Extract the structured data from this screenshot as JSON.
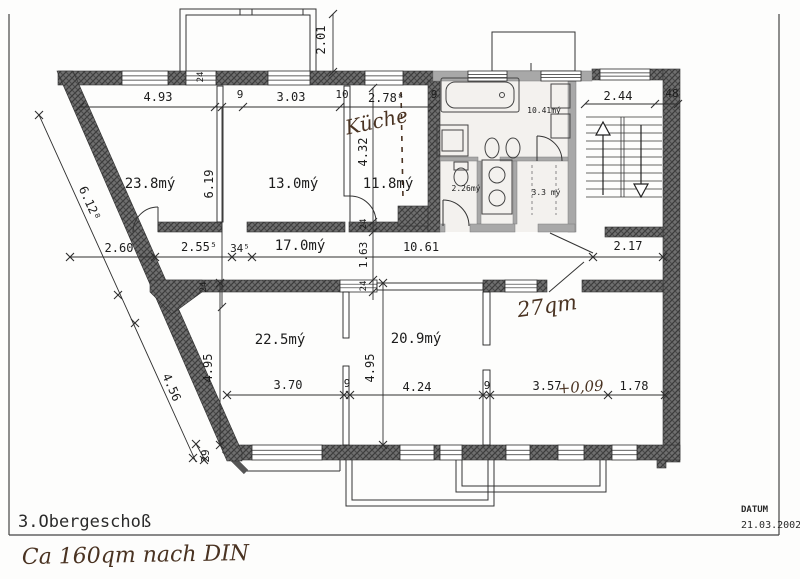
{
  "page": {
    "title": "3.Obergeschoß",
    "datum_label": "DATUM",
    "datum_value": "21.03.2002"
  },
  "plan": {
    "room_labels": [
      {
        "text": "23.8mý",
        "x": 150,
        "y": 188
      },
      {
        "text": "13.0mý",
        "x": 293,
        "y": 188
      },
      {
        "text": "11.8mý",
        "x": 388,
        "y": 188
      },
      {
        "text": "17.0mý",
        "x": 300,
        "y": 250
      },
      {
        "text": "22.5mý",
        "x": 280,
        "y": 344
      },
      {
        "text": "20.9mý",
        "x": 416,
        "y": 343
      },
      {
        "text": "10.41mý",
        "x": 544,
        "y": 113,
        "size": 8
      },
      {
        "text": "2.26mý",
        "x": 466,
        "y": 191,
        "size": 8
      },
      {
        "text": "3.3 mý",
        "x": 546,
        "y": 195,
        "size": 8
      }
    ],
    "dim_labels": [
      {
        "text": "4.93",
        "x": 158,
        "y": 101
      },
      {
        "text": "9",
        "x": 240,
        "y": 98,
        "size": 11
      },
      {
        "text": "3.03",
        "x": 291,
        "y": 101
      },
      {
        "text": "10",
        "x": 342,
        "y": 98,
        "size": 11
      },
      {
        "text": "2.78⁸",
        "x": 386,
        "y": 102
      },
      {
        "text": "9",
        "x": 434,
        "y": 98,
        "size": 11
      },
      {
        "text": "2.44",
        "x": 618,
        "y": 100
      },
      {
        "text": "48",
        "x": 672,
        "y": 97,
        "size": 11
      },
      {
        "text": "2.01",
        "x": 325,
        "y": 40,
        "rot": -90
      },
      {
        "text": "6.19",
        "x": 213,
        "y": 184,
        "rot": -90
      },
      {
        "text": "4.32",
        "x": 367,
        "y": 152,
        "rot": -90
      },
      {
        "text": "1.63",
        "x": 367,
        "y": 255,
        "rot": -90,
        "size": 11
      },
      {
        "text": "24",
        "x": 366,
        "y": 224,
        "rot": -90,
        "size": 9
      },
      {
        "text": "24",
        "x": 366,
        "y": 286,
        "rot": -90,
        "size": 9
      },
      {
        "text": "24",
        "x": 206,
        "y": 287,
        "rot": -90,
        "size": 9
      },
      {
        "text": "24",
        "x": 203,
        "y": 77,
        "rot": -90,
        "size": 9
      },
      {
        "text": "6.12⁸",
        "x": 86,
        "y": 205,
        "rot": 66
      },
      {
        "text": "4.56",
        "x": 168,
        "y": 389,
        "rot": 66
      },
      {
        "text": "2.60",
        "x": 119,
        "y": 252
      },
      {
        "text": "2.55⁵",
        "x": 199,
        "y": 251
      },
      {
        "text": "34⁵",
        "x": 240,
        "y": 252,
        "size": 11
      },
      {
        "text": "10.61",
        "x": 421,
        "y": 251
      },
      {
        "text": "2.17",
        "x": 628,
        "y": 250
      },
      {
        "text": "4.95",
        "x": 212,
        "y": 368,
        "rot": -90
      },
      {
        "text": "4.95",
        "x": 374,
        "y": 368,
        "rot": -90
      },
      {
        "text": "3.70",
        "x": 288,
        "y": 389
      },
      {
        "text": "9",
        "x": 347,
        "y": 387,
        "size": 11
      },
      {
        "text": "4.24",
        "x": 417,
        "y": 391
      },
      {
        "text": "9",
        "x": 487,
        "y": 389,
        "size": 11
      },
      {
        "text": "3.57",
        "x": 547,
        "y": 390
      },
      {
        "text": "1.78",
        "x": 634,
        "y": 390
      },
      {
        "text": "29",
        "x": 209,
        "y": 456,
        "rot": -90,
        "size": 11
      }
    ],
    "handwritten": [
      {
        "text": "Küche",
        "x": 378,
        "y": 128,
        "rot": -12,
        "size": 20
      },
      {
        "text": "27qm",
        "x": 548,
        "y": 313,
        "rot": -8,
        "size": 21
      },
      {
        "text": "+0,09",
        "x": 581,
        "y": 392,
        "rot": -4,
        "size": 15
      },
      {
        "text": "Ca 160qm nach DIN",
        "x": 22,
        "y": 564,
        "rot": -1,
        "size": 22,
        "anchor": "start"
      }
    ]
  }
}
